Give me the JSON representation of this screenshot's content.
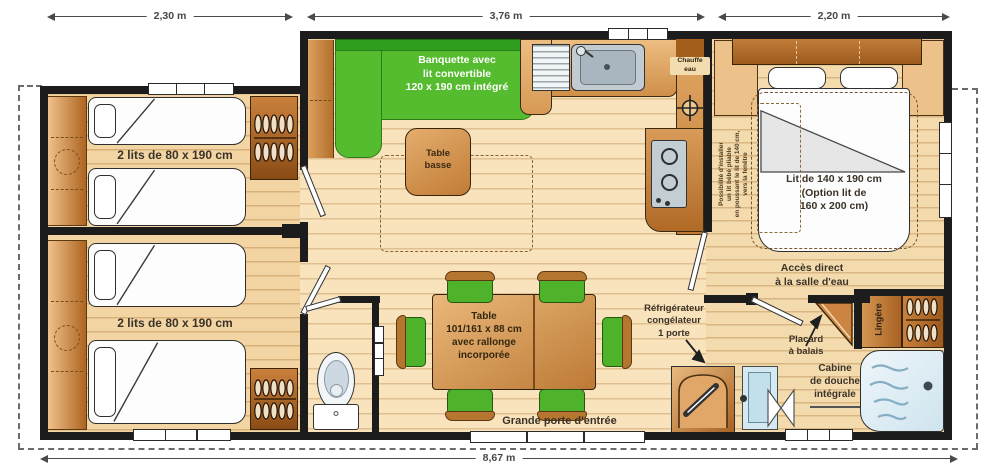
{
  "dims": {
    "left": "2,30 m",
    "middle": "3,76 m",
    "right": "2,20 m",
    "total": "8,67 m"
  },
  "labels": {
    "bedroom1": "2 lits de 80 x 190 cm",
    "bedroom2": "2 lits de 80 x 190 cm",
    "banquette": [
      "Banquette avec",
      "lit convertible",
      "120 x 190 cm intégré"
    ],
    "table_basse": [
      "Table",
      "basse"
    ],
    "chauffe_eau": [
      "Chauffe",
      "eau"
    ],
    "master_bed": [
      "Lit de 140 x 190 cm",
      "(Option lit de",
      "160 x 200 cm)"
    ],
    "baby_bed_note": [
      "Possibilité d'installer",
      "un lit bébé pliable",
      "en poussant le lit de 140 cm,",
      "vers la fenêtre"
    ],
    "access_bathroom": [
      "Accès direct",
      "à la salle d'eau"
    ],
    "fridge": [
      "Réfrigérateur",
      "congélateur",
      "1 porte"
    ],
    "broom_closet": [
      "Placard",
      "à balais"
    ],
    "linen_closet": "Lingère",
    "shower": [
      "Cabine",
      "de douche",
      "intégrale"
    ],
    "dining_table": [
      "Table",
      "101/161 x 88 cm",
      "avec rallonge",
      "incorporée"
    ],
    "entrance": "Grande porte d'entrée"
  },
  "colors": {
    "banquette_green": "#55bb2f",
    "chair_green": "#4eb32a",
    "wood_dark": "#a96224",
    "wood_light": "#f5dcae",
    "wall": "#1c1c1c"
  }
}
